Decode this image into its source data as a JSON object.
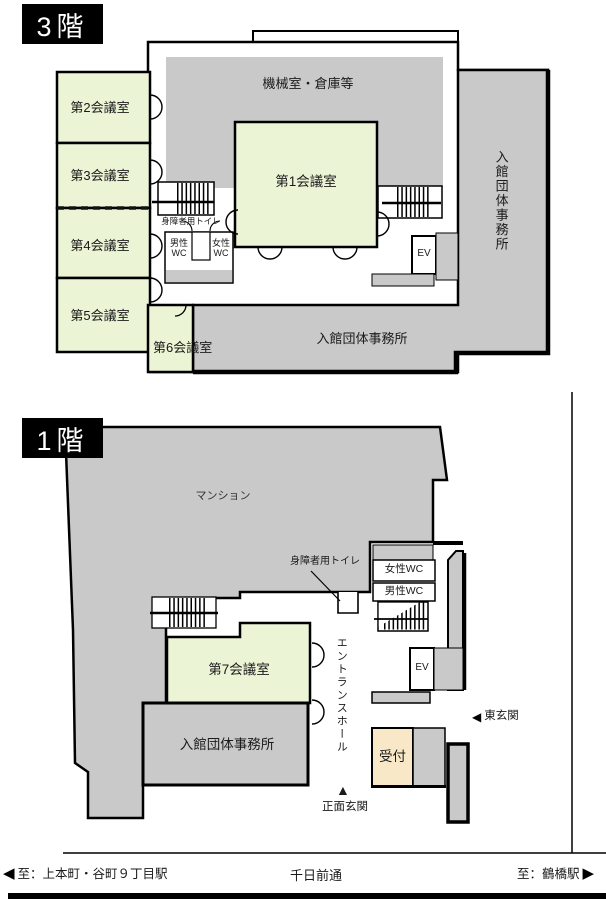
{
  "floor3": {
    "label": "3階",
    "machine_room": "機械室・倉庫等",
    "meeting1": "第1会議室",
    "meeting2": "第2会議室",
    "meeting3": "第3会議室",
    "meeting4": "第4会議室",
    "meeting5": "第5会議室",
    "meeting6": "第6会議室",
    "accessible_toilet": "身障者用トイレ",
    "mens_wc": "男性WC",
    "womens_wc": "女性WC",
    "elevator": "EV",
    "office_right": "入館団体事務所",
    "office_bottom": "入館団体事務所"
  },
  "floor1": {
    "label": "1階",
    "mansion": "マンション",
    "accessible_toilet": "身障者用トイレ",
    "womens_wc": "女性WC",
    "mens_wc": "男性WC",
    "elevator": "EV",
    "entrance_hall": "エントランスホール",
    "meeting7": "第7会議室",
    "office": "入館団体事務所",
    "reception": "受付",
    "east_entrance": "東玄関",
    "main_entrance": "正面玄関"
  },
  "road": {
    "street": "千日前通",
    "to_left": "至：上本町・谷町９丁目駅",
    "to_right": "至：鶴橋駅"
  },
  "icons": {
    "left_arrow": "◀",
    "right_arrow": "▶",
    "up_arrow": "▲"
  },
  "colors": {
    "room_green": "#ecf4d6",
    "block_gray": "#c9c9c9",
    "reception_tan": "#f9e8c8",
    "wall": "#000000"
  }
}
